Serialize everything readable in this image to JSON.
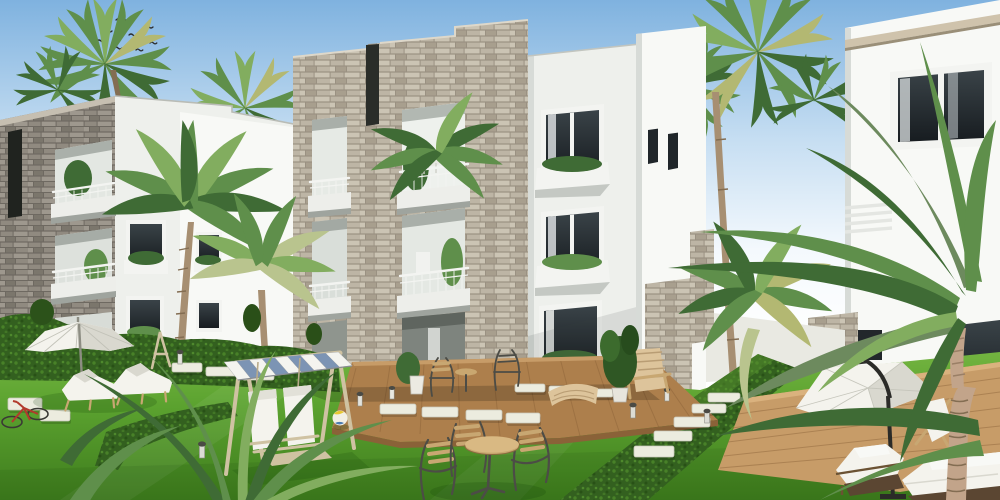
{
  "meta": {
    "type": "architectural-rendering",
    "description": "Sunny 3D architectural rendering of a modern residential compound: white apartment blocks with gray stacked-stone balcony towers surrounding a landscaped garden of palm trees, trimmed hedges, bright lawns, stepping-stone paths, wooden decks and outdoor leisure furniture under a clear hazy-blue sky."
  },
  "palette": {
    "skyTop": "#7fb2df",
    "skyMid": "#c6def2",
    "skyLow": "#f4f9fd",
    "wall": "#eef0ec",
    "wallBright": "#f8f9f6",
    "wallShade": "#d7dbd7",
    "cornice": "#cfc3ac",
    "stoneL1": "#bdb5a5",
    "stoneL2": "#cbc4b4",
    "stoneL3": "#a89f8e",
    "stoneLmortar": "#9a9182",
    "stoneD1": "#908a80",
    "stoneD2": "#9e988e",
    "stoneD3": "#7b766c",
    "stoneDmortar": "#6e6961",
    "glassDark": "#171c20",
    "glassLight": "#3a4348",
    "frameWhite": "#f3f4f1",
    "slab": "#edeeea",
    "slabShadow": "#9fa49e",
    "lawnLight": "#7cbb47",
    "lawnMid": "#5ba22f",
    "lawnDark": "#3e7c1d",
    "hedgeDark": "#33601f",
    "hedgeLight": "#4e8a2b",
    "frondDark": "#3f6b35",
    "frondMid": "#5f8f4b",
    "frondLight": "#82ad5f",
    "frondPale": "#b9c48e",
    "frondGray": "#6d8a5e",
    "fanYellow": "#b3b872",
    "trunk": "#a78f72",
    "trunkDark": "#836d52",
    "trunkPink": "#c2a48a",
    "deckLight": "#c79c68",
    "deckMid": "#ad7f4c",
    "deckDark": "#8a6238",
    "fabric": "#f4f3ed",
    "fabricShade": "#d9d8cf",
    "metal": "#4c4c46",
    "woodFurn": "#c8a772",
    "swingWood": "#cfc2a2",
    "canopyBlue": "#7c94b4",
    "accentRed": "#b23a2c",
    "flowerYellow": "#e7c832",
    "birdDark": "#2c2c2c"
  },
  "scene": {
    "description": "Modern residential compound garden view: stone-clad and white apartment buildings, palm trees, hedges, lawn with stepping stones, decks and outdoor furniture",
    "sky": {
      "condition": "clear, hazy toward horizon",
      "bird_count": 8
    },
    "buildings": [
      {
        "id": "left-stone-tower",
        "material": "dark gray stacked stone",
        "floors": 3,
        "features": [
          "recessed balconies",
          "white railings",
          "balcony plants",
          "narrow dark slot window"
        ]
      },
      {
        "id": "rear-white-block",
        "material": "white render",
        "features": [
          "dark windows",
          "white planter boxes with greenery"
        ]
      },
      {
        "id": "central-stone-tower",
        "material": "light gray stacked stone with white render wing",
        "floors": 3,
        "features": [
          "two recessed balcony bays per floor",
          "white balcony slabs and railings",
          "roof parapet notch",
          "windows with planter boxes",
          "ground-floor terrace with wooden deck"
        ]
      },
      {
        "id": "white-corner-tower",
        "material": "white render",
        "features": [
          "narrow slot windows"
        ]
      },
      {
        "id": "right-villa",
        "material": "white render with stone cornice band",
        "features": [
          "large dark corner window",
          "balcony louvers",
          "stone garden wall",
          "terrace deck with planters and flowers"
        ]
      }
    ],
    "vegetation": {
      "fan_palms": 6,
      "coconut_palms": 5,
      "foreground_palm_fronds": "large arching fronds from right and lower-left",
      "hedges": [
        "long trimmed hedge band below buildings",
        "diagonal mid-lawn hedge",
        "large diagonal hedge wedge on right"
      ],
      "lawn": "bright manicured grass",
      "shrubs": [
        "dark round bushes",
        "yellow-green border bushes",
        "yellow flowers near deck"
      ]
    },
    "furniture": [
      "white garden parasol with two white sun loungers (left)",
      "bicycle lying on grass (far left)",
      "wooden easel stand",
      "wooden swing bench with blue-and-white striped canopy and two white canvas seats",
      "beach ball on lawn",
      "round wooden bistro table with three metal-and-wood chairs",
      "metal bistro chairs, potted plant and adirondack chair with curved footrest on wooden deck",
      "potted tree beside deck",
      "white cantilever parasol with black arm (right terrace)",
      "white folding deck chair on right deck",
      "two white cushioned loungers with dark wicker bases (bottom right)"
    ],
    "hardscape": [
      "stepping-stone walkways across the lawn",
      "wooden deck at central building",
      "wooden terrace deck at right villa"
    ],
    "lighting": [
      "small bollard path lights"
    ]
  }
}
